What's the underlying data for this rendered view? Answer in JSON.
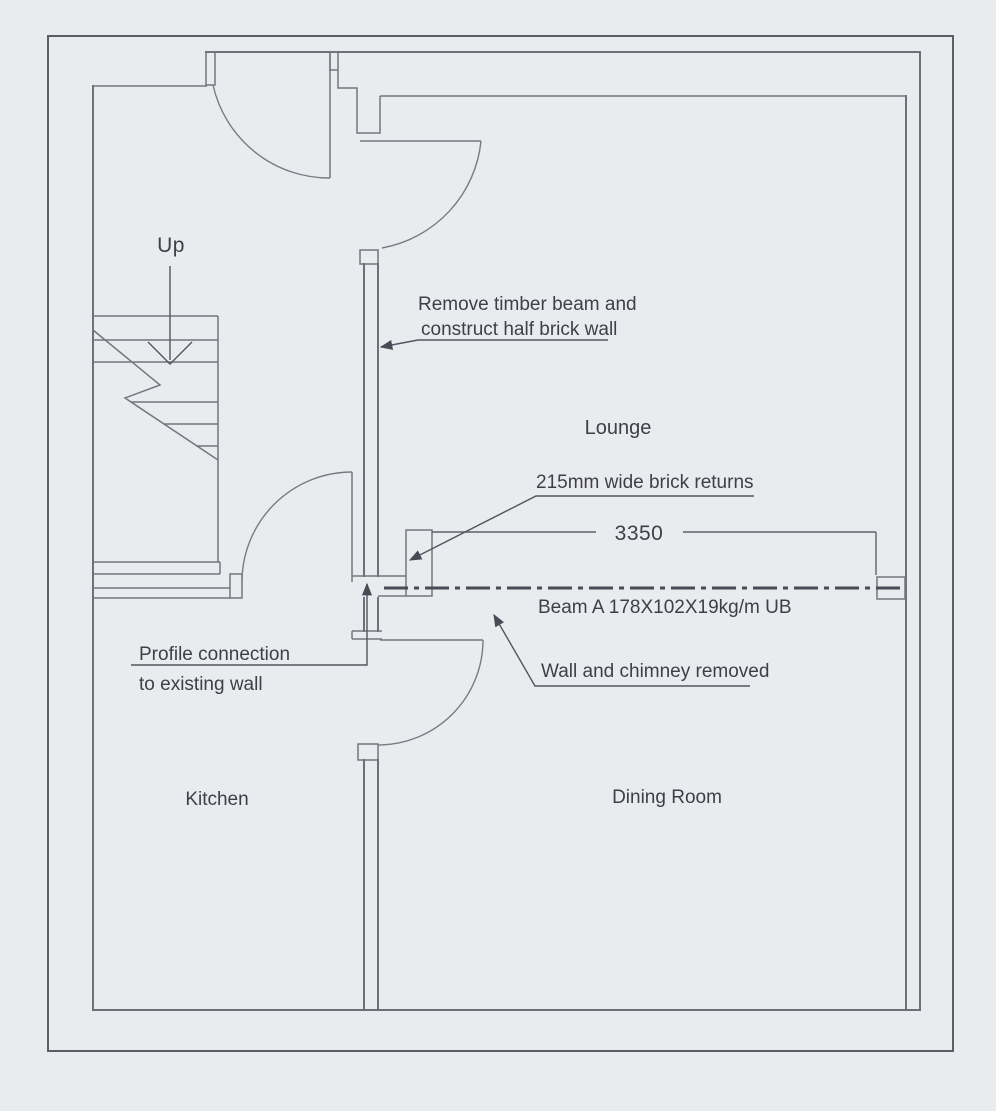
{
  "drawing": {
    "rooms": {
      "lounge": "Lounge",
      "kitchen": "Kitchen",
      "dining_room": "Dining Room"
    },
    "stair_direction_label": "Up",
    "dimensions": {
      "beam_opening_span": "3350"
    },
    "notes": {
      "remove_beam_line1": "Remove timber beam and",
      "remove_beam_line2": "construct half brick wall",
      "brick_returns": "215mm wide brick returns",
      "beam_spec": "Beam A 178X102X19kg/m UB",
      "wall_chimney_removed": "Wall and chimney removed",
      "profile_connection_line1": "Profile connection",
      "profile_connection_line2": "to existing wall"
    },
    "colors": {
      "paper": "#eaebef",
      "wall_line": "#6f6f7a",
      "beam_line": "#4b4b55",
      "text": "#3f3f49"
    }
  }
}
